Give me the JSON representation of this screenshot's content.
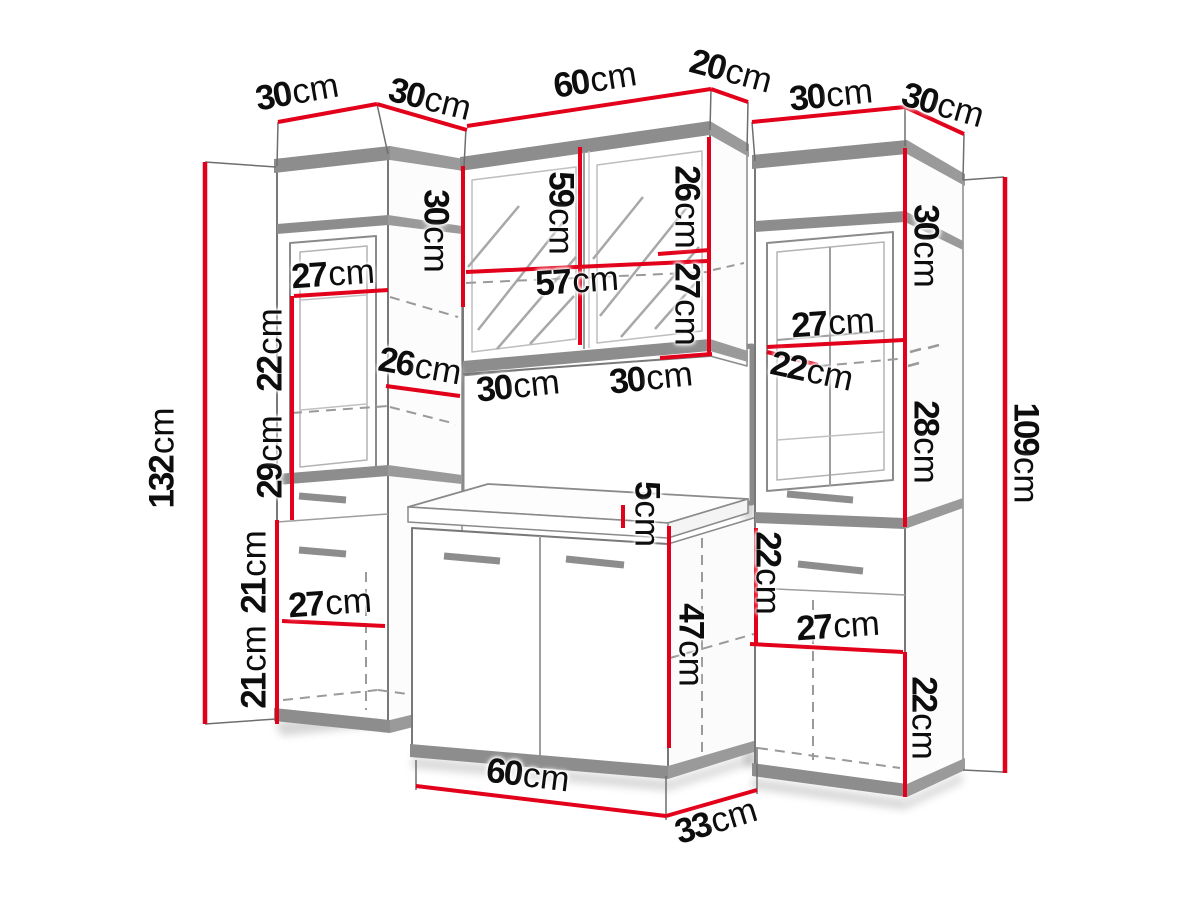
{
  "diagram": {
    "type": "furniture-dimension-diagram",
    "subject": "bathroom furniture set with two tall cabinets, mirror cabinet and vanity unit",
    "unit": "cm"
  },
  "colors": {
    "dimension_line_red": "#e2001a",
    "cabinet_band_gray": "#8d8d8d",
    "outline_gray": "#787878",
    "text_black": "#0d0d0d",
    "background": "#ffffff"
  },
  "measurements": [
    {
      "name": "left-cabinet-width",
      "value": "30",
      "unit": "cm"
    },
    {
      "name": "left-cabinet-depth",
      "value": "30",
      "unit": "cm"
    },
    {
      "name": "mirror-cabinet-width",
      "value": "60",
      "unit": "cm"
    },
    {
      "name": "mirror-cabinet-depth",
      "value": "20",
      "unit": "cm"
    },
    {
      "name": "right-cabinet-width",
      "value": "30",
      "unit": "cm"
    },
    {
      "name": "right-cabinet-depth",
      "value": "30",
      "unit": "cm"
    },
    {
      "name": "left-total-height",
      "value": "132",
      "unit": "cm"
    },
    {
      "name": "left-shelf-width",
      "value": "27",
      "unit": "cm"
    },
    {
      "name": "left-upper-section-height",
      "value": "22",
      "unit": "cm"
    },
    {
      "name": "left-mid-section-height",
      "value": "29",
      "unit": "cm"
    },
    {
      "name": "left-inner-depth",
      "value": "26",
      "unit": "cm"
    },
    {
      "name": "mirror-left-section-height",
      "value": "30",
      "unit": "cm"
    },
    {
      "name": "mirror-door-height",
      "value": "59",
      "unit": "cm"
    },
    {
      "name": "mirror-upper-right-height",
      "value": "26",
      "unit": "cm"
    },
    {
      "name": "mirror-inner-width",
      "value": "57",
      "unit": "cm"
    },
    {
      "name": "mirror-lower-right-height",
      "value": "27",
      "unit": "cm"
    },
    {
      "name": "mirror-door-left-width",
      "value": "30",
      "unit": "cm"
    },
    {
      "name": "mirror-door-right-width",
      "value": "30",
      "unit": "cm"
    },
    {
      "name": "countertop-height",
      "value": "5",
      "unit": "cm"
    },
    {
      "name": "vanity-door-height",
      "value": "47",
      "unit": "cm"
    },
    {
      "name": "vanity-width",
      "value": "60",
      "unit": "cm"
    },
    {
      "name": "vanity-depth",
      "value": "33",
      "unit": "cm"
    },
    {
      "name": "right-top-section-height",
      "value": "30",
      "unit": "cm"
    },
    {
      "name": "right-shelf-width",
      "value": "27",
      "unit": "cm"
    },
    {
      "name": "right-inner-depth",
      "value": "22",
      "unit": "cm"
    },
    {
      "name": "right-mid-section-height",
      "value": "28",
      "unit": "cm"
    },
    {
      "name": "right-total-height",
      "value": "109",
      "unit": "cm"
    },
    {
      "name": "right-drawer-section-height",
      "value": "22",
      "unit": "cm"
    },
    {
      "name": "right-lower-shelf-width",
      "value": "27",
      "unit": "cm"
    },
    {
      "name": "right-bottom-section-height",
      "value": "22",
      "unit": "cm"
    },
    {
      "name": "left-lower-section-1-height",
      "value": "21",
      "unit": "cm"
    },
    {
      "name": "left-lower-section-2-height",
      "value": "21",
      "unit": "cm"
    },
    {
      "name": "left-lower-shelf-width",
      "value": "27",
      "unit": "cm"
    }
  ]
}
